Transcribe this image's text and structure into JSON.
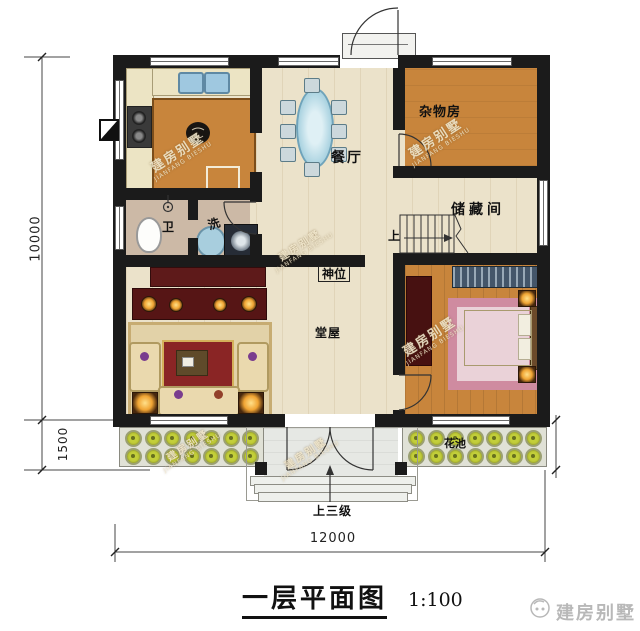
{
  "watermark": {
    "line1": "建房别墅",
    "line2": "JIANFANG BIESHU"
  },
  "title": {
    "text": "一层平面图",
    "scale": "1:100"
  },
  "brand": {
    "name": "建房别墅"
  },
  "dimensions": {
    "left_height": "10000",
    "left_porch": "1500",
    "bottom_width": "12000"
  },
  "rooms": {
    "dining": "餐厅",
    "utility": "杂物房",
    "storage": "储藏间",
    "hall": "堂屋",
    "altar": "神位",
    "toilet": "卫",
    "laundry": "洗",
    "flower_bed": "花池",
    "stair_up": "上",
    "entry_steps": "上三级"
  },
  "colors": {
    "wall": "#1b1b1b",
    "wood": "#c8853c",
    "floor": "#ebe2ca",
    "altar_red": "#5e1a1a"
  }
}
